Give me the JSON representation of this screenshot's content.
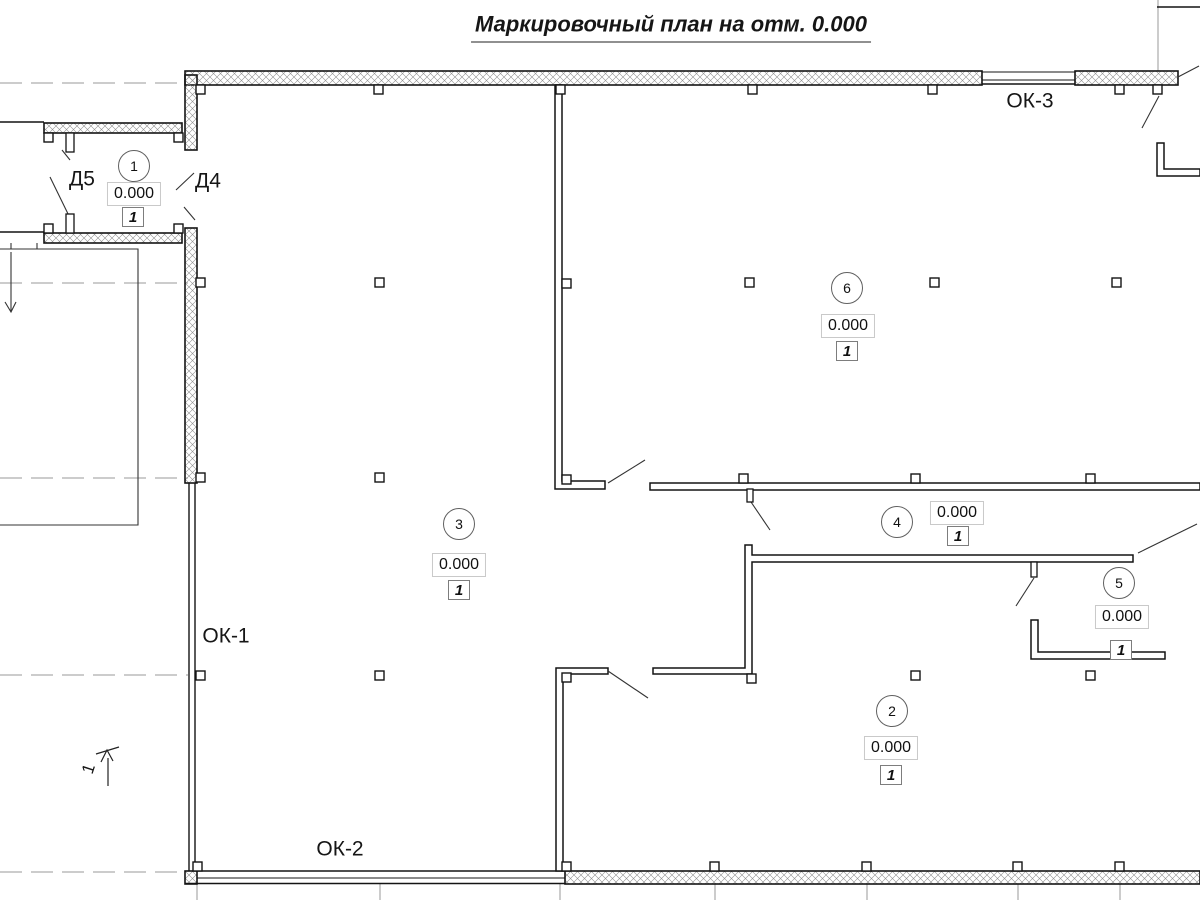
{
  "title": "Маркировочный план на отм. 0.000",
  "rooms": [
    {
      "number": "1",
      "elevation": "0.000",
      "floor_type": "1"
    },
    {
      "number": "3",
      "elevation": "0.000",
      "floor_type": "1"
    },
    {
      "number": "6",
      "elevation": "0.000",
      "floor_type": "1"
    },
    {
      "number": "4",
      "elevation": "0.000",
      "floor_type": "1"
    },
    {
      "number": "5",
      "elevation": "0.000",
      "floor_type": "1"
    },
    {
      "number": "2",
      "elevation": "0.000",
      "floor_type": "1"
    }
  ],
  "doors": [
    {
      "label": "Д5"
    },
    {
      "label": "Д4"
    }
  ],
  "windows": [
    {
      "label": "ОК-1"
    },
    {
      "label": "ОК-2"
    },
    {
      "label": "ОК-3"
    }
  ],
  "section": {
    "label": "1"
  },
  "colors": {
    "line": "#141414",
    "grid": "#9a9a9a",
    "hatch": "#909090"
  }
}
